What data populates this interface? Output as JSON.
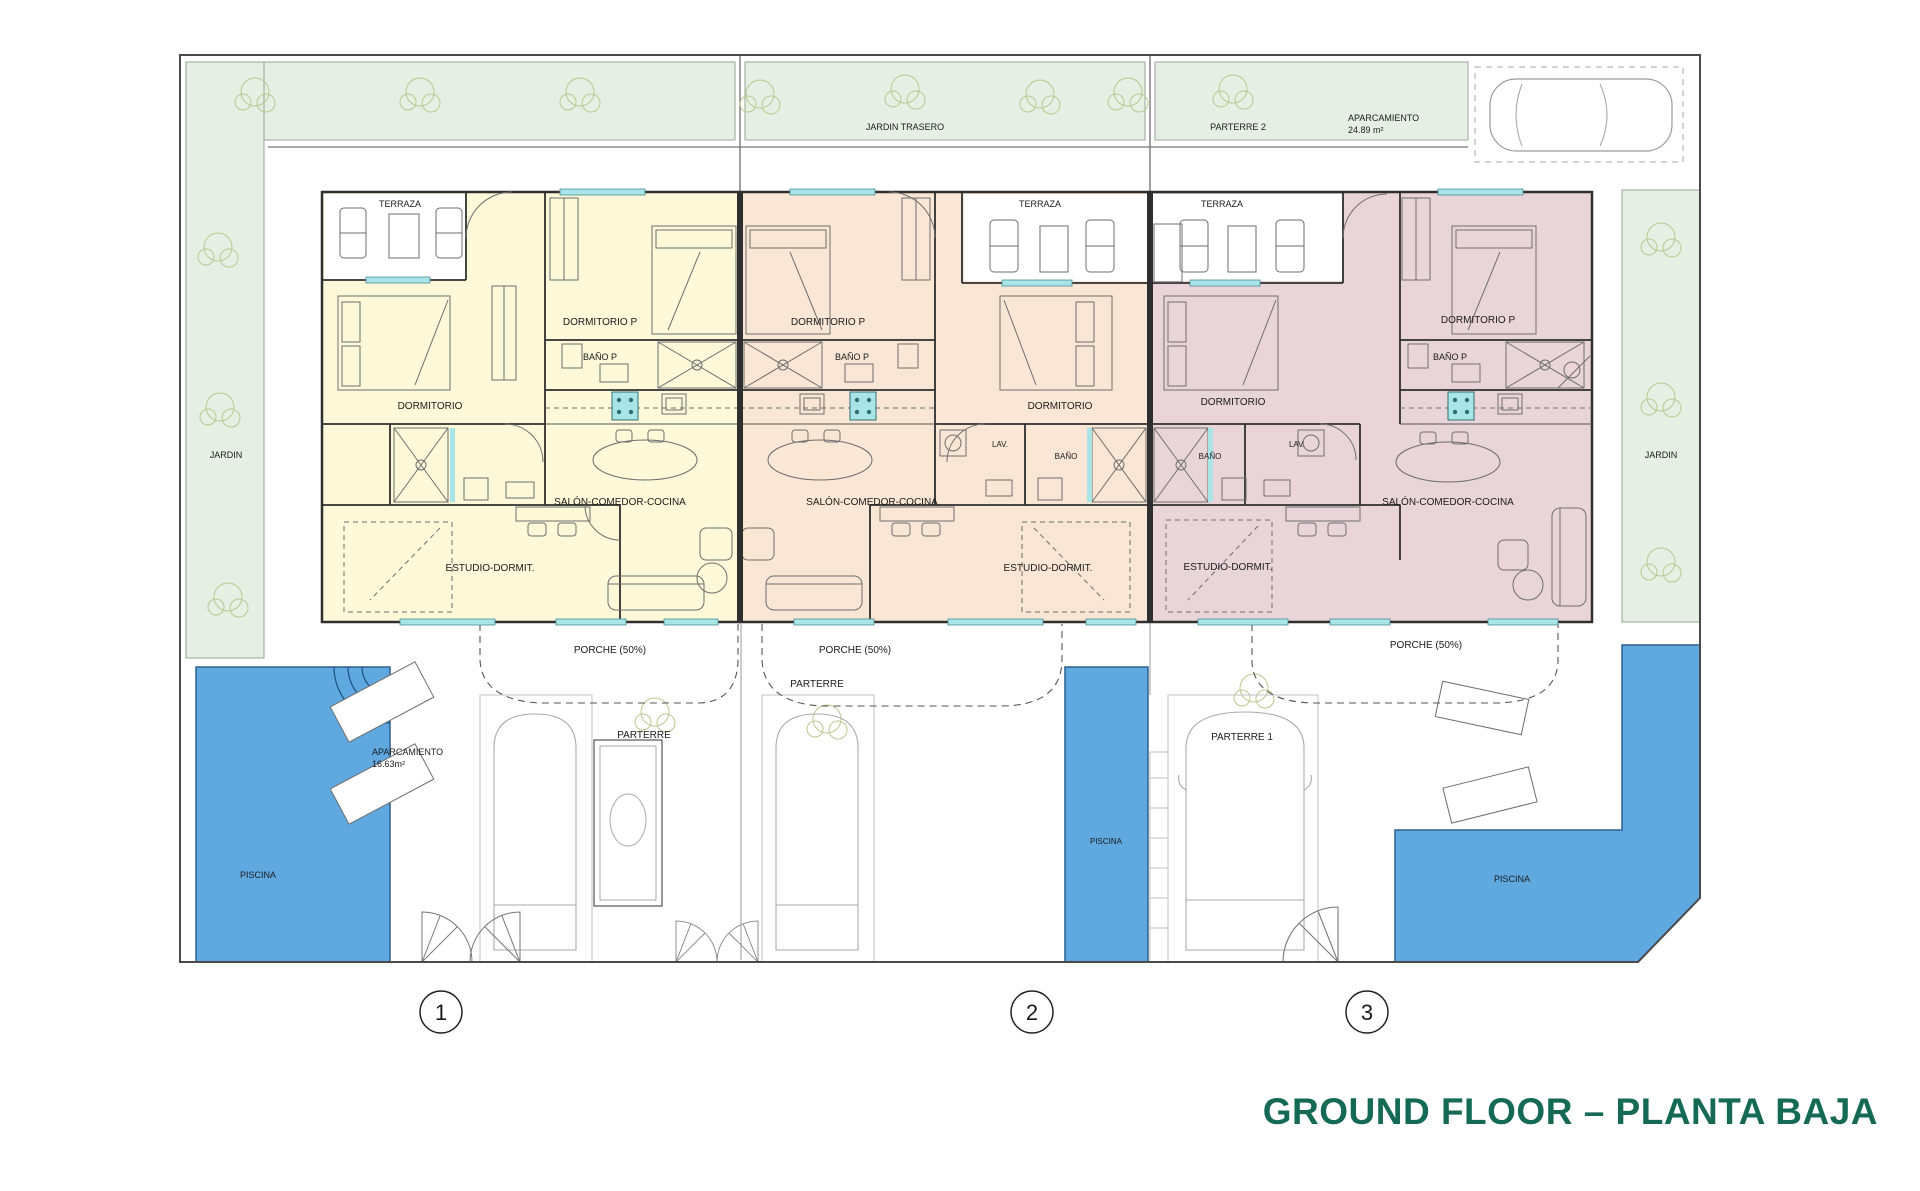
{
  "title": "GROUND FLOOR – PLANTA BAJA",
  "colors": {
    "unit1_fill": "#fcf8d8",
    "unit2_fill": "#fae6d4",
    "unit3_fill": "#e9d4d9",
    "pool_blue": "#5fa8e0",
    "garden_green": "#e6efe3",
    "window_cyan": "#a9e5e7",
    "title_green": "#156a55"
  },
  "site": {
    "jardin_left": "JARDIN",
    "jardin_trasero": "JARDIN TRASERO",
    "parterre_2": "PARTERRE 2",
    "jardin_right": "JARDIN",
    "aparcamiento_top": {
      "line1": "APARCAMIENTO",
      "line2": "24.89 m²"
    }
  },
  "units": [
    {
      "number": "1",
      "rooms": {
        "terraza": "TERRAZA",
        "dormitorio_p": "DORMITORIO P",
        "bano_p": "BAÑO P",
        "dormitorio": "DORMITORIO",
        "salon": "SALÓN-COMEDOR-COCINA",
        "estudio": "ESTUDIO-DORMIT."
      },
      "porche": "PORCHE (50%)",
      "parterre": "PARTERRE",
      "piscina": "PISCINA",
      "aparcamiento": {
        "line1": "APARCAMIENTO",
        "line2": "16.63m²"
      }
    },
    {
      "number": "2",
      "rooms": {
        "terraza": "TERRAZA",
        "dormitorio_p": "DORMITORIO P",
        "bano_p": "BAÑO P",
        "dormitorio": "DORMITORIO",
        "lav": "LAV.",
        "bano": "BAÑO",
        "salon": "SALÓN-COMEDOR-COCINA",
        "estudio": "ESTUDIO-DORMIT."
      },
      "porche": "PORCHE (50%)",
      "parterre": "PARTERRE",
      "piscina": "PISCINA"
    },
    {
      "number": "3",
      "rooms": {
        "terraza": "TERRAZA",
        "dormitorio": "DORMITORIO",
        "bano": "BAÑO",
        "lav": "LAV.",
        "dormitorio_p": "DORMITORIO P",
        "bano_p": "BAÑO P",
        "salon": "SALÓN-COMEDOR-COCINA",
        "estudio": "ESTUDIO-DORMIT."
      },
      "porche": "PORCHE (50%)",
      "parterre_1": "PARTERRE 1",
      "piscina": "PISCINA"
    }
  ]
}
